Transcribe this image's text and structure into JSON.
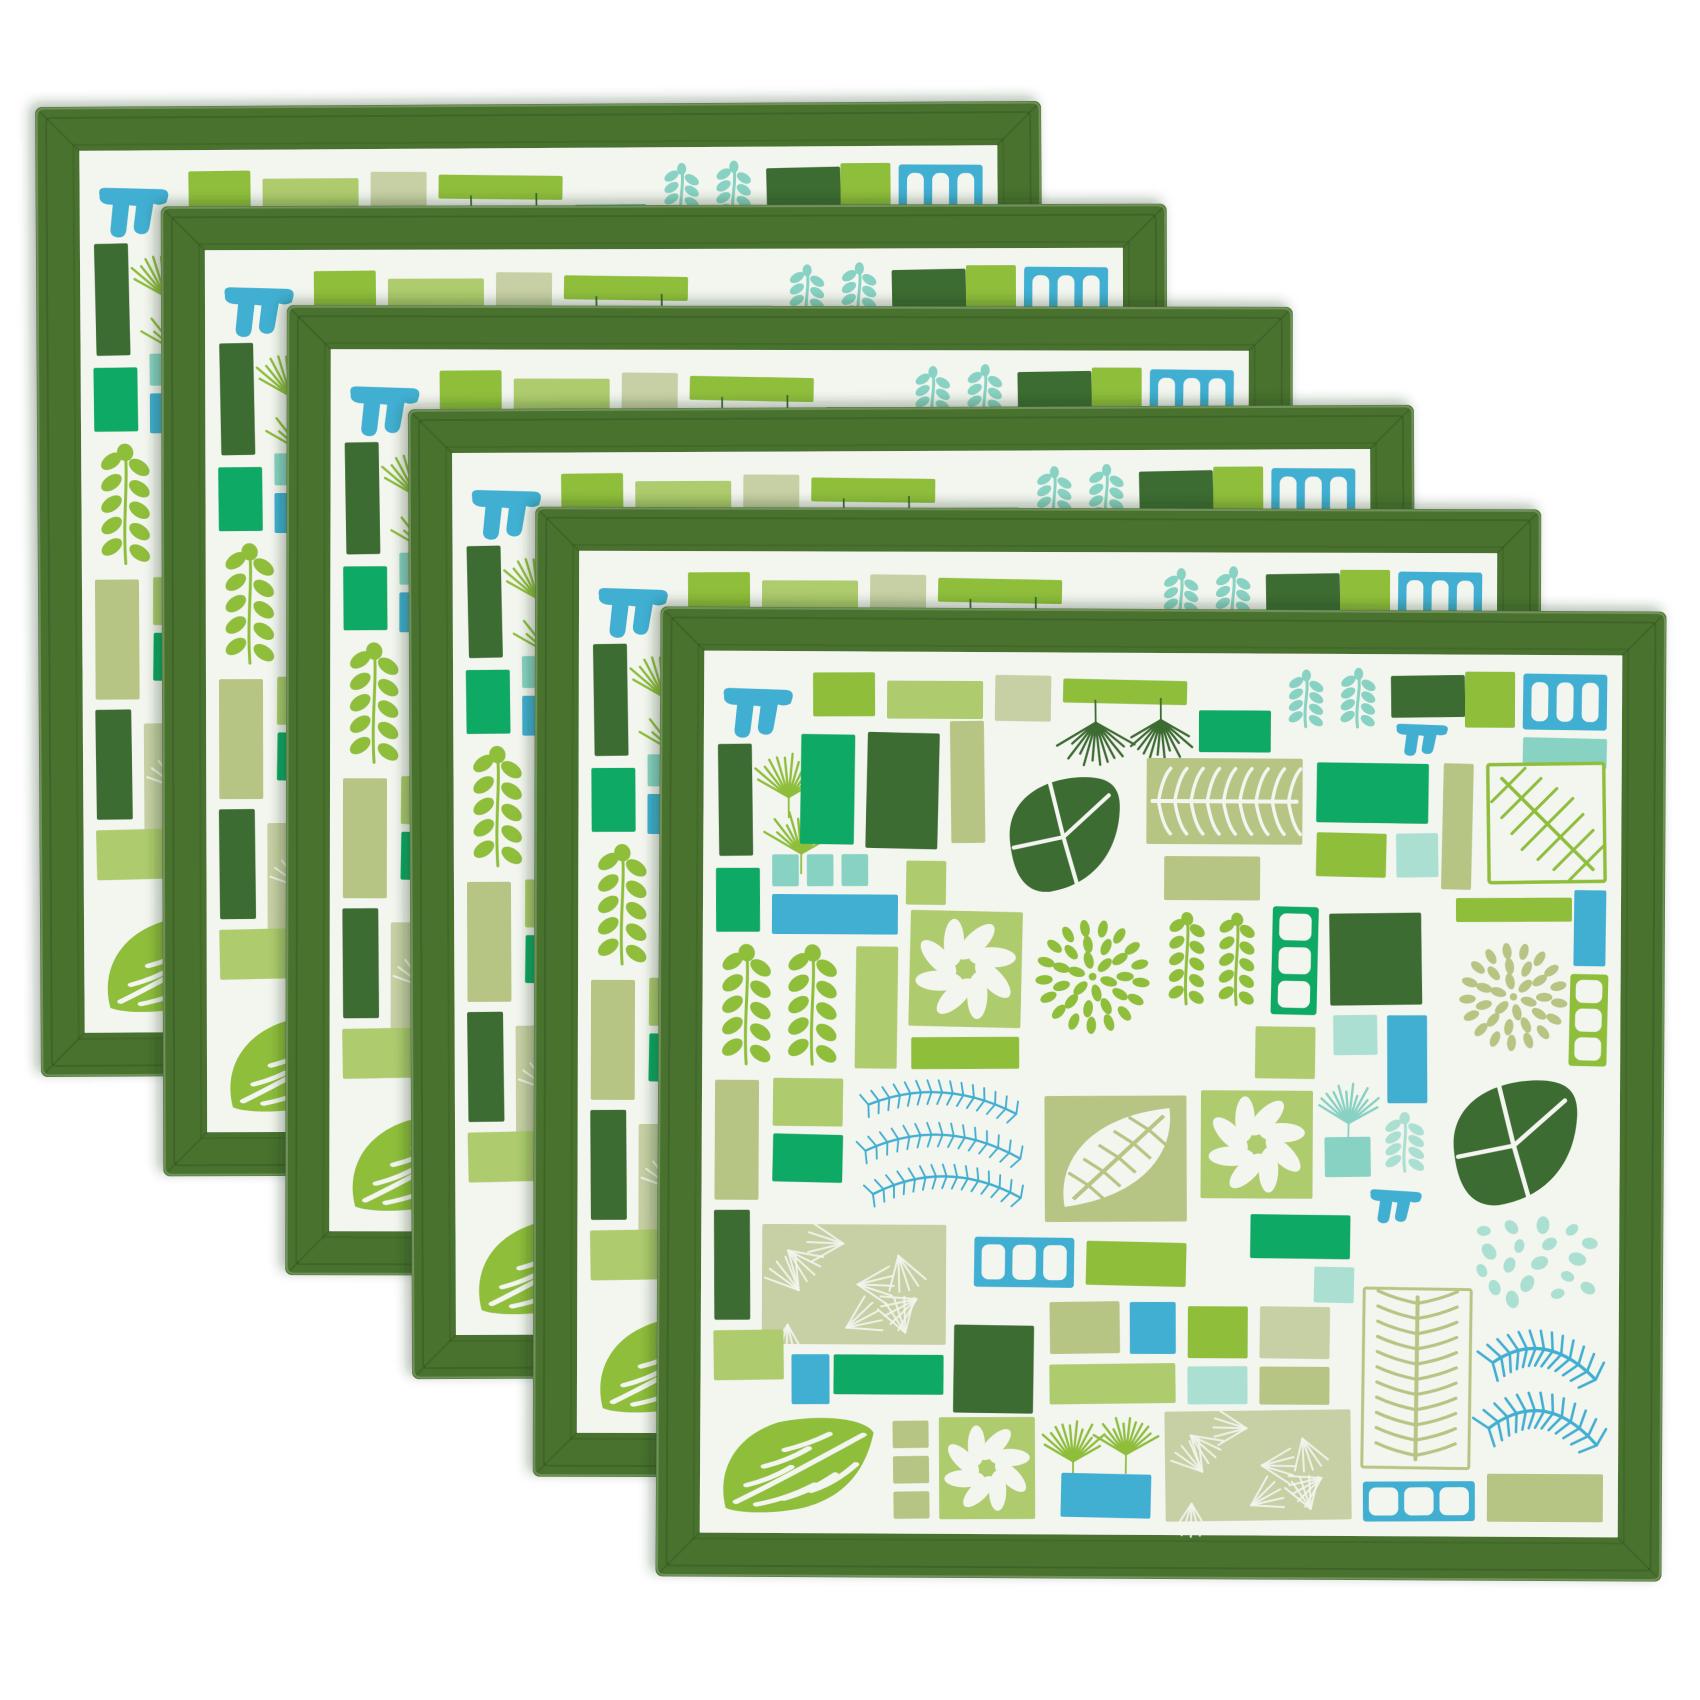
{
  "image": {
    "type": "product-photo",
    "description": "Stack of six identical square placemats fanned diagonally from upper left to lower right on a white background. Each placemat has a wide dark green mitered fabric border and a white center printed with a tropical botanical mosaic of green, sage, emerald, teal and aqua rectangles, fan palms, ferns, corals and leaf motifs.",
    "background": "#ffffff"
  },
  "product": {
    "item": "placemat set",
    "quantity": 6,
    "border_color_name": "dark green",
    "pattern_name": "tropical leaf mosaic",
    "motifs": [
      "fan-palm",
      "fern-frond",
      "big-leaf",
      "seaweed-coral",
      "petal-burst",
      "palm-texture",
      "pinwheel-flower",
      "window-brick",
      "comb-squiggle",
      "pebbles",
      "chevron-leaf",
      "color-block-rectangles"
    ]
  },
  "palette": {
    "border": "#49722f",
    "dark": "#3d6c33",
    "emerald": "#10a965",
    "chartreuse": "#8fbe3a",
    "ltgreen": "#aecb6d",
    "sage": "#b6c583",
    "palesage": "#c7cfa4",
    "teal": "#3fafd2",
    "aqua": "#88d2c3",
    "ltaqua": "#abdfd2",
    "matWhite": "#f3f5ef",
    "shadow": "#1e3314"
  },
  "layout": {
    "mat": {
      "w": 1006,
      "h": 970,
      "border": 44,
      "padding": 13
    },
    "stack": {
      "count": 6,
      "x0": 38,
      "y0": 104,
      "dx": 124,
      "dy": 101,
      "rotations": [
        -0.35,
        -0.15,
        0.1,
        -0.25,
        0.15,
        0.3
      ]
    }
  },
  "tiles": [
    {
      "m": "comb",
      "c": "teal",
      "x": 2,
      "y": 20,
      "w": 78,
      "h": 56
    },
    {
      "m": "rect",
      "c": "chartreuse",
      "x": 96,
      "y": 8,
      "w": 62,
      "h": 44
    },
    {
      "m": "rect",
      "c": "ltgreen",
      "x": 170,
      "y": 16,
      "w": 96,
      "h": 38
    },
    {
      "m": "rect",
      "c": "palesage",
      "x": 278,
      "y": 10,
      "w": 56,
      "h": 46
    },
    {
      "m": "rect",
      "c": "chartreuse",
      "x": 346,
      "y": 14,
      "w": 124,
      "h": 24
    },
    {
      "m": "fan",
      "c": "dark",
      "v": "up",
      "x": 352,
      "y": 46,
      "w": 54,
      "h": 50
    },
    {
      "m": "fan",
      "c": "dark",
      "v": "up",
      "x": 418,
      "y": 44,
      "w": 52,
      "h": 46
    },
    {
      "m": "rect",
      "c": "emerald",
      "x": 482,
      "y": 44,
      "w": 72,
      "h": 42
    },
    {
      "m": "coral",
      "c": "aqua",
      "x": 566,
      "y": 4,
      "w": 46,
      "h": 60
    },
    {
      "m": "coral",
      "c": "aqua",
      "x": 618,
      "y": 2,
      "w": 46,
      "h": 62
    },
    {
      "m": "rect",
      "c": "dark",
      "x": 674,
      "y": 8,
      "w": 74,
      "h": 42
    },
    {
      "m": "comb",
      "c": "teal",
      "x": 676,
      "y": 54,
      "w": 58,
      "h": 36
    },
    {
      "m": "rect",
      "c": "chartreuse",
      "x": 748,
      "y": 4,
      "w": 50,
      "h": 56
    },
    {
      "m": "window",
      "c": "teal",
      "x": 806,
      "y": 6,
      "w": 84,
      "h": 56
    },
    {
      "m": "rect",
      "c": "aqua",
      "x": 806,
      "y": 70,
      "w": 84,
      "h": 30
    },
    {
      "m": "rect",
      "c": "dark",
      "x": 2,
      "y": 80,
      "w": 34,
      "h": 112
    },
    {
      "m": "fan",
      "c": "chartreuse",
      "v": "down",
      "x": 44,
      "y": 92,
      "w": 56,
      "h": 50
    },
    {
      "m": "fan",
      "c": "chartreuse",
      "v": "down",
      "x": 58,
      "y": 150,
      "w": 54,
      "h": 48
    },
    {
      "m": "rect",
      "c": "emerald",
      "x": 84,
      "y": 70,
      "w": 54,
      "h": 110
    },
    {
      "m": "rect",
      "c": "dark",
      "x": 150,
      "y": 68,
      "w": 72,
      "h": 116
    },
    {
      "m": "rect",
      "c": "sage",
      "x": 234,
      "y": 56,
      "w": 34,
      "h": 122
    },
    {
      "m": "bigleaf",
      "c": "dark",
      "x": 280,
      "y": 104,
      "w": 134,
      "h": 130
    },
    {
      "m": "fernH",
      "c": "sage",
      "x": 430,
      "y": 92,
      "w": 156,
      "h": 86
    },
    {
      "m": "rect",
      "c": "emerald",
      "x": 600,
      "y": 96,
      "w": 112,
      "h": 60
    },
    {
      "m": "rect",
      "c": "sage",
      "x": 726,
      "y": 96,
      "w": 30,
      "h": 126
    },
    {
      "m": "leafbox",
      "c": "chartreuse",
      "x": 770,
      "y": 94,
      "w": 120,
      "h": 122
    },
    {
      "m": "minirow",
      "c": "aqua",
      "x": 56,
      "y": 190,
      "w": 96,
      "h": 32
    },
    {
      "m": "rect",
      "c": "teal",
      "x": 56,
      "y": 230,
      "w": 126,
      "h": 40
    },
    {
      "m": "rect",
      "c": "ltgreen",
      "x": 190,
      "y": 196,
      "w": 40,
      "h": 44
    },
    {
      "m": "rect",
      "c": "chartreuse",
      "x": 600,
      "y": 166,
      "w": 70,
      "h": 44
    },
    {
      "m": "rect",
      "c": "ltaqua",
      "x": 680,
      "y": 166,
      "w": 42,
      "h": 44
    },
    {
      "m": "rect",
      "c": "emerald",
      "x": 0,
      "y": 204,
      "w": 44,
      "h": 64
    },
    {
      "m": "fernsq",
      "c": "chartreuse",
      "x": 0,
      "y": 280,
      "w": 128,
      "h": 126
    },
    {
      "m": "rect",
      "c": "ltgreen",
      "x": 140,
      "y": 282,
      "w": 42,
      "h": 122
    },
    {
      "m": "flower",
      "c": "ltgreen",
      "x": 194,
      "y": 246,
      "w": 112,
      "h": 116
    },
    {
      "m": "burst",
      "c": "chartreuse",
      "x": 318,
      "y": 252,
      "w": 118,
      "h": 118
    },
    {
      "m": "rect",
      "c": "chartreuse",
      "x": 196,
      "y": 372,
      "w": 108,
      "h": 32
    },
    {
      "m": "rect",
      "c": "sage",
      "x": 448,
      "y": 190,
      "w": 96,
      "h": 44
    },
    {
      "m": "fernsq",
      "c": "chartreuse",
      "x": 448,
      "y": 246,
      "w": 96,
      "h": 98
    },
    {
      "m": "window",
      "c": "emerald",
      "x": 556,
      "y": 240,
      "w": 46,
      "h": 108
    },
    {
      "m": "rect",
      "c": "dark",
      "x": 614,
      "y": 246,
      "w": 92,
      "h": 92
    },
    {
      "m": "rect",
      "c": "chartreuse",
      "x": 740,
      "y": 230,
      "w": 116,
      "h": 24
    },
    {
      "m": "burst",
      "c": "sage",
      "x": 742,
      "y": 264,
      "w": 112,
      "h": 130
    },
    {
      "m": "rect",
      "c": "teal",
      "x": 858,
      "y": 222,
      "w": 32,
      "h": 76
    },
    {
      "m": "window",
      "c": "chartreuse",
      "x": 854,
      "y": 306,
      "w": 38,
      "h": 92
    },
    {
      "m": "rect",
      "c": "ltaqua",
      "x": 618,
      "y": 348,
      "w": 44,
      "h": 40
    },
    {
      "m": "rect",
      "c": "teal",
      "x": 672,
      "y": 348,
      "w": 40,
      "h": 88
    },
    {
      "m": "rect",
      "c": "sage",
      "x": 0,
      "y": 416,
      "w": 44,
      "h": 120
    },
    {
      "m": "rect",
      "c": "ltgreen",
      "x": 58,
      "y": 414,
      "w": 70,
      "h": 48
    },
    {
      "m": "rect",
      "c": "emerald",
      "x": 58,
      "y": 470,
      "w": 70,
      "h": 48
    },
    {
      "m": "fernswirl",
      "c": "teal",
      "x": 140,
      "y": 408,
      "w": 176,
      "h": 140
    },
    {
      "m": "palmleaf",
      "c": "sage",
      "x": 330,
      "y": 430,
      "w": 142,
      "h": 126
    },
    {
      "m": "flower",
      "c": "ltgreen",
      "x": 486,
      "y": 424,
      "w": 112,
      "h": 108
    },
    {
      "m": "rect",
      "c": "ltgreen",
      "x": 540,
      "y": 360,
      "w": 60,
      "h": 52
    },
    {
      "m": "fan",
      "c": "aqua",
      "v": "down",
      "x": 610,
      "y": 420,
      "w": 48,
      "h": 44
    },
    {
      "m": "rect",
      "c": "aqua",
      "x": 610,
      "y": 470,
      "w": 46,
      "h": 40
    },
    {
      "m": "coral",
      "c": "ltaqua",
      "x": 664,
      "y": 446,
      "w": 52,
      "h": 62
    },
    {
      "m": "bigleaf",
      "c": "dark",
      "x": 724,
      "y": 404,
      "w": 150,
      "h": 142
    },
    {
      "m": "rect",
      "c": "emerald",
      "x": 536,
      "y": 548,
      "w": 100,
      "h": 44
    },
    {
      "m": "comb",
      "c": "teal",
      "x": 652,
      "y": 520,
      "w": 58,
      "h": 38
    },
    {
      "m": "pebbles",
      "c": "ltaqua",
      "x": 760,
      "y": 552,
      "w": 126,
      "h": 86
    },
    {
      "m": "rect",
      "c": "dark",
      "x": 0,
      "y": 546,
      "w": 36,
      "h": 110
    },
    {
      "m": "palmtex",
      "c": "palesage",
      "x": 48,
      "y": 560,
      "w": 184,
      "h": 120
    },
    {
      "m": "window",
      "c": "teal",
      "x": 260,
      "y": 572,
      "w": 100,
      "h": 50
    },
    {
      "m": "rect",
      "c": "chartreuse",
      "x": 372,
      "y": 576,
      "w": 100,
      "h": 44
    },
    {
      "m": "rect",
      "c": "sage",
      "x": 336,
      "y": 636,
      "w": 70,
      "h": 52
    },
    {
      "m": "rect",
      "c": "teal",
      "x": 416,
      "y": 636,
      "w": 46,
      "h": 52
    },
    {
      "m": "rect",
      "c": "chartreuse",
      "x": 474,
      "y": 640,
      "w": 60,
      "h": 52
    },
    {
      "m": "rect",
      "c": "palesage",
      "x": 546,
      "y": 640,
      "w": 70,
      "h": 52
    },
    {
      "m": "rect",
      "c": "ltaqua",
      "x": 600,
      "y": 600,
      "w": 40,
      "h": 36
    },
    {
      "m": "rect",
      "c": "ltgreen",
      "x": 336,
      "y": 698,
      "w": 126,
      "h": 40
    },
    {
      "m": "rect",
      "c": "ltaqua",
      "x": 474,
      "y": 700,
      "w": 60,
      "h": 38
    },
    {
      "m": "rect",
      "c": "sage",
      "x": 546,
      "y": 700,
      "w": 70,
      "h": 38
    },
    {
      "m": "fernV",
      "c": "sage",
      "x": 648,
      "y": 620,
      "w": 110,
      "h": 182
    },
    {
      "m": "fernblue",
      "c": "teal",
      "x": 766,
      "y": 652,
      "w": 126,
      "h": 146
    },
    {
      "m": "rect",
      "c": "ltgreen",
      "x": 0,
      "y": 666,
      "w": 70,
      "h": 50
    },
    {
      "m": "rect",
      "c": "teal",
      "x": 78,
      "y": 690,
      "w": 38,
      "h": 50
    },
    {
      "m": "rect",
      "c": "emerald",
      "x": 120,
      "y": 690,
      "w": 110,
      "h": 40
    },
    {
      "m": "rect",
      "c": "dark",
      "x": 240,
      "y": 660,
      "w": 80,
      "h": 88
    },
    {
      "m": "chevleaf",
      "c": "chartreuse",
      "x": 0,
      "y": 748,
      "w": 170,
      "h": 106
    },
    {
      "m": "minicol",
      "c": "sage",
      "x": 180,
      "y": 756,
      "w": 36,
      "h": 98
    },
    {
      "m": "flower",
      "c": "ltgreen",
      "x": 226,
      "y": 752,
      "w": 96,
      "h": 102
    },
    {
      "m": "fan",
      "c": "chartreuse",
      "v": "down",
      "x": 334,
      "y": 758,
      "w": 52,
      "h": 46
    },
    {
      "m": "fan",
      "c": "chartreuse",
      "v": "down",
      "x": 390,
      "y": 754,
      "w": 46,
      "h": 42
    },
    {
      "m": "rect",
      "c": "teal",
      "x": 348,
      "y": 808,
      "w": 90,
      "h": 44
    },
    {
      "m": "palmtex",
      "c": "palesage",
      "x": 452,
      "y": 744,
      "w": 186,
      "h": 110
    },
    {
      "m": "window",
      "c": "teal",
      "x": 650,
      "y": 814,
      "w": 112,
      "h": 40
    },
    {
      "m": "rect",
      "c": "sage",
      "x": 774,
      "y": 806,
      "w": 116,
      "h": 48
    }
  ]
}
